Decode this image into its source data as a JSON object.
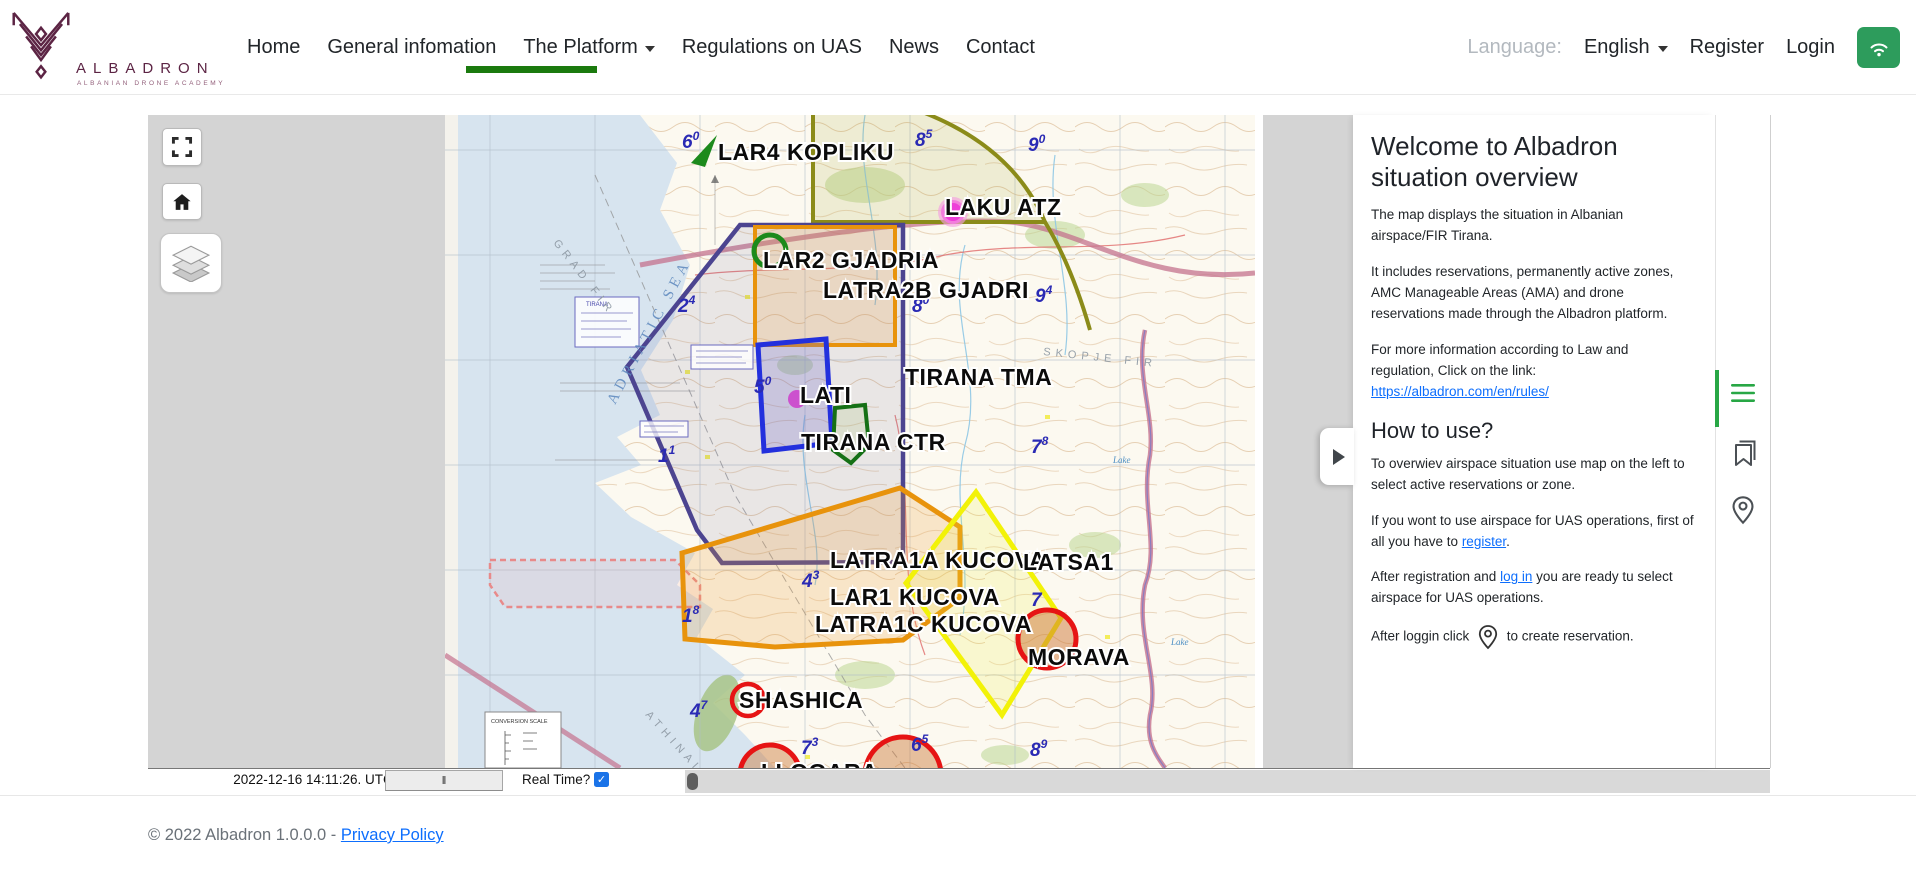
{
  "colors": {
    "brand_maroon": "#5c2444",
    "nav_active_green": "#1b7a0e",
    "button_green": "#2d9c5c",
    "sidebar_green": "#28a745",
    "link_blue": "#0d6efd",
    "checkbox_blue": "#1a73e8",
    "map_gray": "#d4d4d4"
  },
  "header": {
    "brand": {
      "name": "ALBADRON",
      "subtitle": "ALBANIAN DRONE ACADEMY"
    },
    "nav": [
      {
        "label": "Home"
      },
      {
        "label": "General infomation"
      },
      {
        "label": "The Platform",
        "has_dropdown": true,
        "active": true
      },
      {
        "label": "Regulations on UAS"
      },
      {
        "label": "News"
      },
      {
        "label": "Contact"
      }
    ],
    "language_label": "Language:",
    "language_value": "English",
    "register_label": "Register",
    "login_label": "Login"
  },
  "map": {
    "controls": [
      "fullscreen",
      "home",
      "layers"
    ],
    "zone_colors": {
      "tma": "#4c4490",
      "olive": "#8b8b19",
      "orange": "#e8930c",
      "lati": "#2330dd",
      "ctr": "#157015",
      "yellow": "#f2f208",
      "red": "#e61414",
      "green-marker": "#1c8a1c",
      "magenta": "#e838d8"
    },
    "zone_labels": [
      {
        "text": "LAR4 KOPLIKU",
        "x": 273,
        "y": 45
      },
      {
        "text": "LAKU ATZ",
        "x": 500,
        "y": 100
      },
      {
        "text": "LAR2 GJADRIA",
        "x": 318,
        "y": 153
      },
      {
        "text": "LATRA2B GJADRI",
        "x": 378,
        "y": 183
      },
      {
        "text": "TIRANA TMA",
        "x": 460,
        "y": 270
      },
      {
        "text": "LATI",
        "x": 355,
        "y": 288
      },
      {
        "text": "TIRANA CTR",
        "x": 356,
        "y": 335
      },
      {
        "text": "LATRA1A KUCOVA",
        "x": 385,
        "y": 453
      },
      {
        "text": "LATSA1",
        "x": 578,
        "y": 455
      },
      {
        "text": "LAR1 KUCOVA",
        "x": 385,
        "y": 490
      },
      {
        "text": "LATRA1C KUCOVA",
        "x": 370,
        "y": 517
      },
      {
        "text": "MORAVA",
        "x": 583,
        "y": 550
      },
      {
        "text": "SHASHICA",
        "x": 294,
        "y": 593
      },
      {
        "text": "LLOGARA",
        "x": 316,
        "y": 665
      }
    ],
    "blue_numbers": [
      {
        "n": "6",
        "s": "0",
        "x": 237,
        "y": 33
      },
      {
        "n": "8",
        "s": "5",
        "x": 470,
        "y": 31
      },
      {
        "n": "9",
        "s": "0",
        "x": 583,
        "y": 36
      },
      {
        "n": "2",
        "s": "4",
        "x": 233,
        "y": 197
      },
      {
        "n": "8",
        "s": "0",
        "x": 467,
        "y": 197
      },
      {
        "n": "9",
        "s": "4",
        "x": 590,
        "y": 187
      },
      {
        "n": "5",
        "s": "0",
        "x": 309,
        "y": 278
      },
      {
        "n": "1",
        "s": "1",
        "x": 213,
        "y": 347
      },
      {
        "n": "7",
        "s": "8",
        "x": 586,
        "y": 338
      },
      {
        "n": "4",
        "s": "3",
        "x": 357,
        "y": 472
      },
      {
        "n": "1",
        "s": "8",
        "x": 237,
        "y": 507
      },
      {
        "n": "7",
        "s": "",
        "x": 586,
        "y": 491
      },
      {
        "n": "4",
        "s": "7",
        "x": 245,
        "y": 602
      },
      {
        "n": "7",
        "s": "3",
        "x": 356,
        "y": 639
      },
      {
        "n": "6",
        "s": "5",
        "x": 466,
        "y": 636
      },
      {
        "n": "8",
        "s": "9",
        "x": 585,
        "y": 641
      }
    ],
    "chart_texts": {
      "adriatic_sea": "ADRIATIC SEA",
      "skopje_fir": "SKOPJE FIR",
      "grad_fir": "GRAD FIR",
      "athinai_fir": "ATHINAI FIR",
      "conversion_scale": "CONVERSION SCALE",
      "tirana_box": "TIRANA",
      "lake1": "Lake",
      "lake2": "Lake"
    }
  },
  "timebar": {
    "timestamp": "2022-12-16 14:11:26. UTC",
    "pause_label": "‖",
    "realtime_label": "Real Time?",
    "realtime_checked": true,
    "check_glyph": "✓"
  },
  "panel": {
    "title": "Welcome to Albadron situation overview",
    "p1": "The map displays the situation in Albanian airspace/FIR Tirana.",
    "p2": "It includes reservations, permanently active zones, AMC Manageable Areas (AMA) and drone reservations made through the Albadron platform.",
    "p3_prefix": "For more information according to Law and regulation, Click on the link: ",
    "p3_link": "https://albadron.com/en/rules/",
    "howto_title": "How to use?",
    "h1": "To overwiev airspace situation use map on the left to select active reservations or zone.",
    "h2_prefix": "If you wont to use airspace for UAS operations, first of all you have to ",
    "h2_link": "register",
    "h2_suffix": ".",
    "h3_prefix": "After registration and ",
    "h3_link": "log in",
    "h3_suffix": " you are ready tu select airspace for UAS operations.",
    "h4_prefix": "After loggin click ",
    "h4_suffix": " to create reservation."
  },
  "footer": {
    "copyright": "© 2022 Albadron 1.0.0.0 - ",
    "privacy_label": "Privacy Policy"
  }
}
